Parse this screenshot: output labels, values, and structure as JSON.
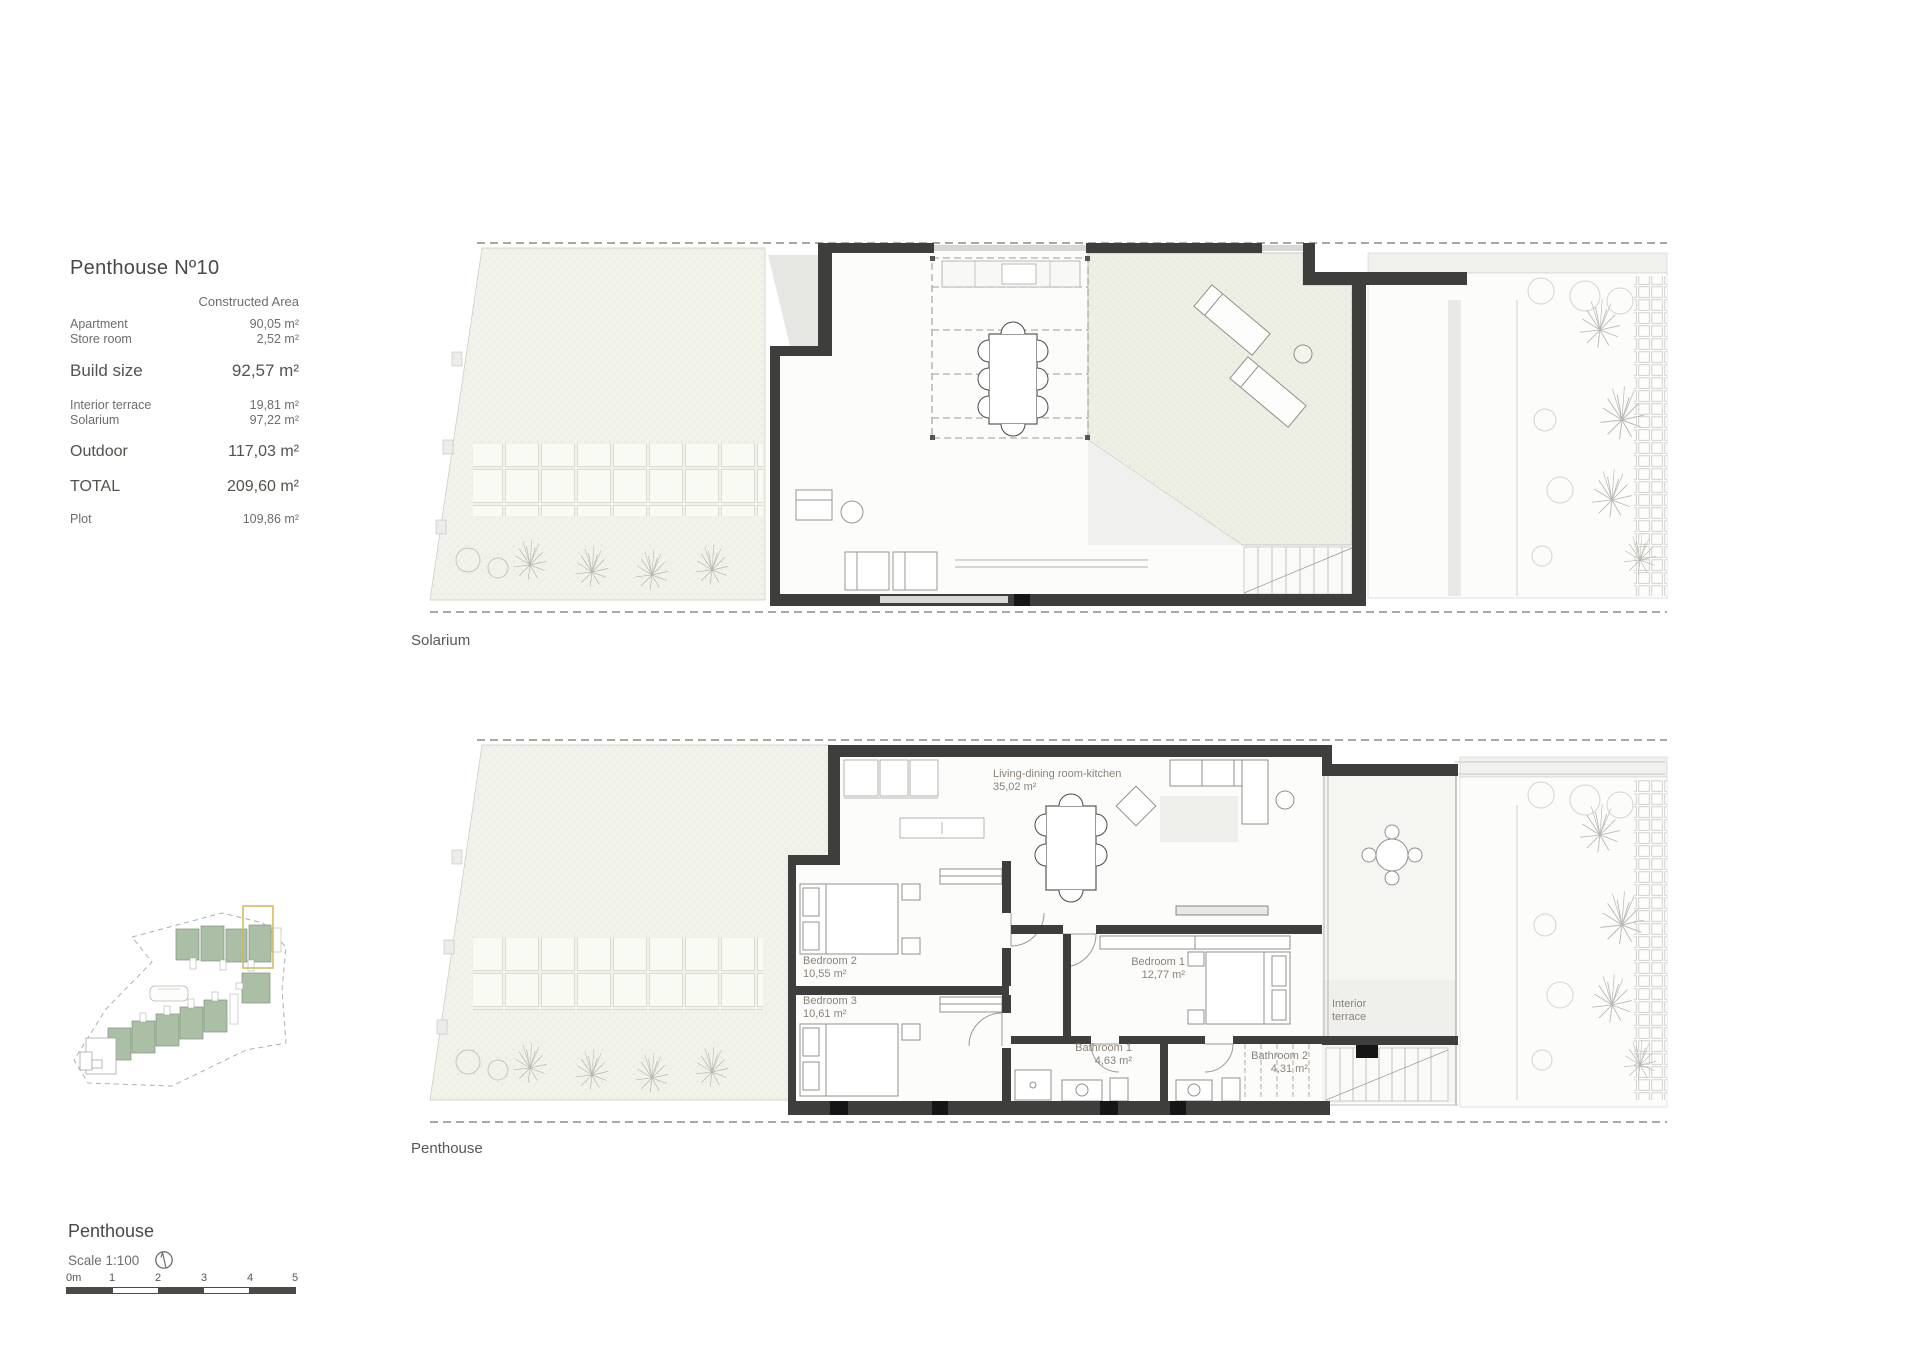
{
  "info_panel": {
    "title": "Penthouse Nº10",
    "column_header": "Constructed Area",
    "constructed_rows": [
      {
        "label": "Apartment",
        "value": "90,05 m²"
      },
      {
        "label": "Store room",
        "value": "2,52 m²"
      }
    ],
    "build_size_label": "Build size",
    "build_size_value": "92,57 m²",
    "outdoor_rows": [
      {
        "label": "Interior terrace",
        "value": "19,81 m²"
      },
      {
        "label": "Solarium",
        "value": "97,22 m²"
      }
    ],
    "outdoor_label": "Outdoor",
    "outdoor_value": "117,03 m²",
    "total_label": "TOTAL",
    "total_value": "209,60 m²",
    "plot_label": "Plot",
    "plot_value": "109,86 m²"
  },
  "solarium_plan": {
    "caption": "Solarium"
  },
  "penthouse_plan": {
    "caption": "Penthouse",
    "rooms": {
      "living": {
        "name": "Living-dining room-kitchen",
        "area": "35,02 m²"
      },
      "bedroom1": {
        "name": "Bedroom 1",
        "area": "12,77 m²"
      },
      "bedroom2": {
        "name": "Bedroom 2",
        "area": "10,55 m²"
      },
      "bedroom3": {
        "name": "Bedroom 3",
        "area": "10,61 m²"
      },
      "bathroom1": {
        "name": "Bathroom 1",
        "area": "4,63 m²"
      },
      "bathroom2": {
        "name": "Bathroom 2",
        "area": "4,31 m²"
      },
      "interior_terrace": "Interior terrace"
    }
  },
  "footer": {
    "plan_title": "Penthouse",
    "scale_label": "Scale 1:100",
    "scale_ticks": [
      "0m",
      "1",
      "2",
      "3",
      "4",
      "5"
    ]
  },
  "colors": {
    "wall": "#3e3e3c",
    "garden_fill": "#f1f2e9",
    "highlight_unit": "#cdb95a",
    "site_building_green": "#abbfa6"
  }
}
